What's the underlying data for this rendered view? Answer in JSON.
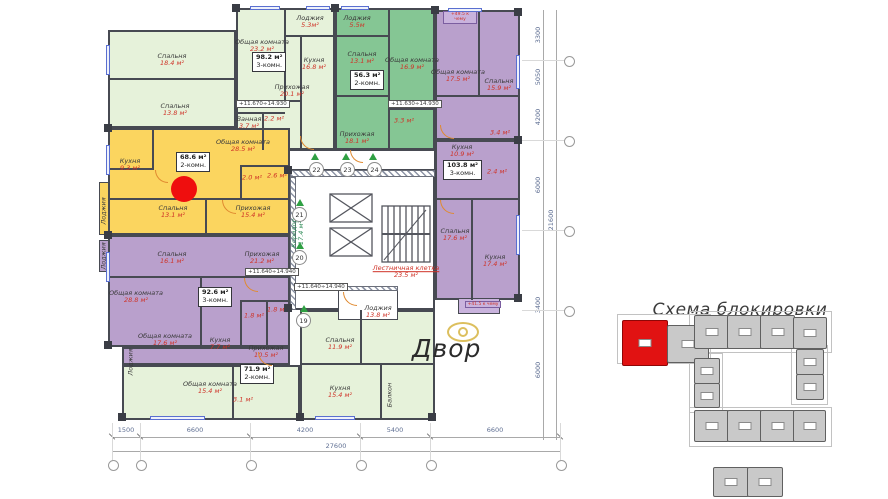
{
  "scheme": {
    "title": "Схема блокировки"
  },
  "courtyard": {
    "label": "Двор"
  },
  "plan": {
    "marker_color": "#ef0e0e",
    "apartments": [
      {
        "name": "apt-top-left",
        "rooms": [
          {
            "n": "Спальня",
            "a": "18.4 м²"
          },
          {
            "n": "Спальня",
            "a": "13.8 м²"
          }
        ]
      },
      {
        "name": "apt-top-middle",
        "summary_area": "98.2 м²",
        "summary_type": "3-комн.",
        "rooms": [
          {
            "n": "Лоджия",
            "a": "5.3м²"
          },
          {
            "n": "Общая комната",
            "a": "23.2 м²"
          },
          {
            "n": "Кухня",
            "a": "16.8 м²"
          },
          {
            "n": "Прихожая",
            "a": "20.1 м²"
          },
          {
            "n": "Ванная",
            "a": "3.7 м²"
          },
          {
            "n": "С/У",
            "a": "2.2 м²"
          }
        ]
      },
      {
        "name": "apt-top-green",
        "summary_area": "56.3 м²",
        "summary_type": "2-комн.",
        "rooms": [
          {
            "n": "Лоджия",
            "a": "5.5м"
          },
          {
            "n": "Спальня",
            "a": "13.1 м²"
          },
          {
            "n": "Общая комната",
            "a": "16.9 м²"
          },
          {
            "n": "Прихожая",
            "a": "18.1 м²"
          },
          {
            "n": "С/У",
            "a": "3.3 м²"
          }
        ]
      },
      {
        "name": "apt-top-right",
        "rooms": [
          {
            "n": "Общая комната",
            "a": "17.5 м²"
          },
          {
            "n": "Спальня",
            "a": "15.9 м²"
          },
          {
            "n": "С/У",
            "a": "3.4 м²"
          }
        ]
      },
      {
        "name": "apt-right",
        "summary_area": "103.8 м²",
        "summary_type": "3-комн.",
        "rooms": [
          {
            "n": "Кухня",
            "a": "10.9 м²"
          },
          {
            "n": "С/У",
            "a": "2.4 м²"
          },
          {
            "n": "Спальня",
            "a": "17.6 м²"
          },
          {
            "n": "Кухня",
            "a": "17.4 м²"
          }
        ]
      },
      {
        "name": "apt-yellow",
        "summary_area": "68.6 м²",
        "summary_type": "2-комн.",
        "rooms": [
          {
            "n": "Кухня",
            "a": "9.3 м²"
          },
          {
            "n": "Общая комната",
            "a": "28.5 м²"
          },
          {
            "n": "Спальня",
            "a": "13.1 м²"
          },
          {
            "n": "Прихожая",
            "a": "15.4 м²"
          },
          {
            "n": "Лоджия",
            "a": "5.0 м²"
          },
          {
            "n": "Туалет",
            "a": "2.0 м²"
          },
          {
            "n": "Ванная",
            "a": "2.6 м²"
          }
        ]
      },
      {
        "name": "apt-purple-left",
        "summary_area": "92.6 м²",
        "summary_type": "3-комн.",
        "rooms": [
          {
            "n": "Спальня",
            "a": "16.1 м²"
          },
          {
            "n": "Лоджия",
            "a": "5.3 м²"
          },
          {
            "n": "Общая комната",
            "a": "28.8 м²"
          },
          {
            "n": "Прихожая",
            "a": "21.2 м²"
          },
          {
            "n": "Общая комната",
            "a": "17.6 м²"
          },
          {
            "n": "Кухня",
            "a": "7.7 м²"
          },
          {
            "n": "Лоджия",
            "a": "7.4 м²"
          },
          {
            "n": "Ванная",
            "a": "1.8 м²"
          },
          {
            "n": "С/У",
            "a": "1.8 м²"
          }
        ]
      },
      {
        "name": "apt-bottom",
        "summary_area": "71.9 м²",
        "summary_type": "2-комн.",
        "rooms": [
          {
            "n": "Общая комната",
            "a": "15.4 м²"
          },
          {
            "n": "Прихожая",
            "a": "10.5 м²"
          },
          {
            "n": "Ванная",
            "a": "3.1 м²"
          },
          {
            "n": "Спальня",
            "a": "11.9 м²"
          },
          {
            "n": "Кухня",
            "a": "15.4 м²"
          },
          {
            "n": "Балкон",
            "a": "3.4 м²"
          },
          {
            "n": "Лоджия",
            "a": "13.8 м²"
          }
        ]
      }
    ],
    "core": {
      "stairs_n": "Лестничная клетка",
      "stairs_a": "23.5 м²",
      "corridor_n": "Коридор",
      "corridor_a": "17.4 м²"
    },
    "entrances": {
      "e19": "19",
      "e20": "20",
      "e21": "21",
      "e22": "22",
      "e23": "23",
      "e24": "24"
    },
    "elevations": {
      "m1": "+11.670÷14.930",
      "m2": "+11.630÷14.930",
      "m3": "+11.640÷14.940",
      "m4": "+11.640÷14.940"
    },
    "balcony_chips": {
      "top": "+49.5 к чему",
      "right": "+41.5 к чему"
    },
    "dims": {
      "bottom": [
        "1500",
        "6600",
        "4200",
        "5400",
        "6600"
      ],
      "bottom_total": "27600",
      "right": [
        "3300",
        "5050",
        "4200",
        "6000",
        "3400",
        "6000"
      ],
      "right_total": "21600"
    }
  }
}
